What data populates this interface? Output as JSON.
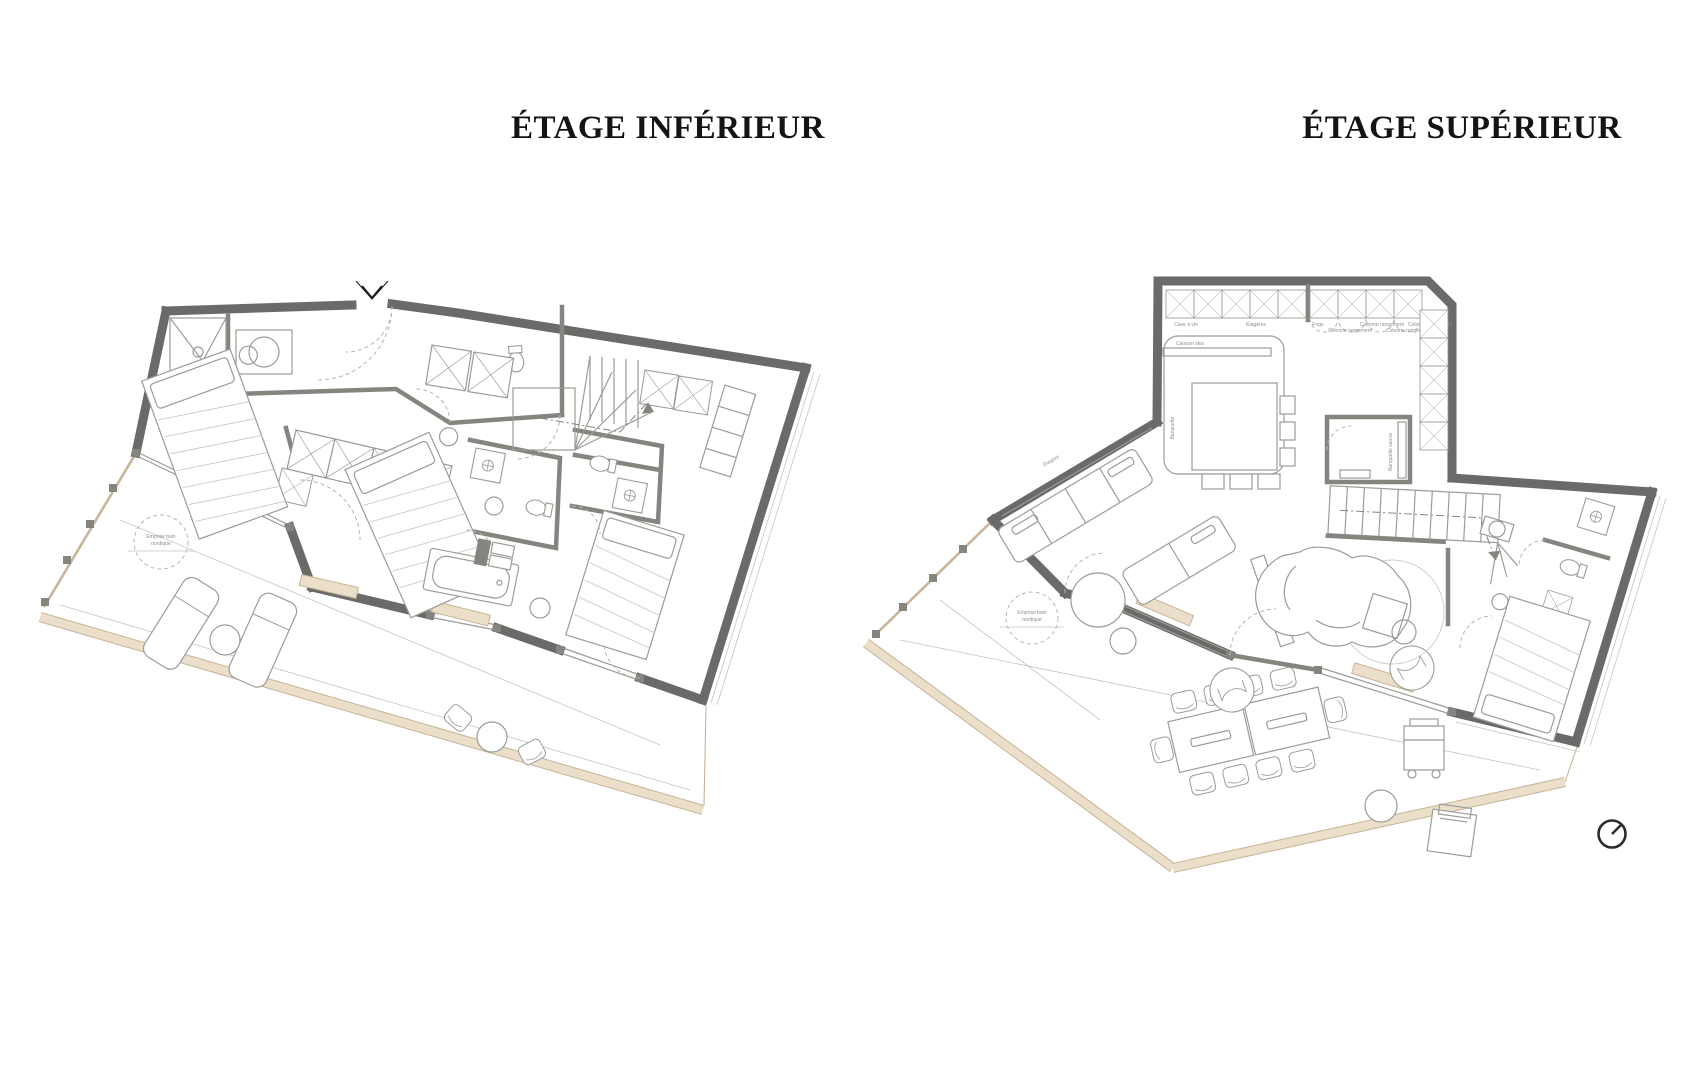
{
  "titles": {
    "left": "ÉTAGE INFÉRIEUR",
    "right": "ÉTAGE SUPÉRIEUR"
  },
  "terrace": {
    "nordic_bath_line1": "Emprise bain",
    "nordic_bath_line2": "nordique"
  },
  "kitchen": {
    "cabinet_labels": [
      "Cave à vin",
      "Étagères",
      "Frigo",
      "Colonne rangement",
      "Colonne rangement",
      "Colonne rangement",
      "Colonne Four + MO"
    ],
    "island_bench": "Banquette",
    "ski_box": "Caisson skis"
  },
  "sauna": {
    "bench_label": "Banquette sauna"
  },
  "living": {
    "shelf_label": "Étagère",
    "tv_label": "TV 65\""
  },
  "icons": {
    "compass": "north-arrow-icon"
  },
  "colors": {
    "wall": "#6a6a68",
    "partition": "#85857f",
    "furniture": "#9b9b97",
    "light": "#c4c4c0",
    "dash": "#b5b5b1",
    "beige": "#ecdfc9",
    "tan": "#c9b498",
    "label": "#8f8f8b",
    "text": "#141414",
    "bg": "#ffffff"
  }
}
